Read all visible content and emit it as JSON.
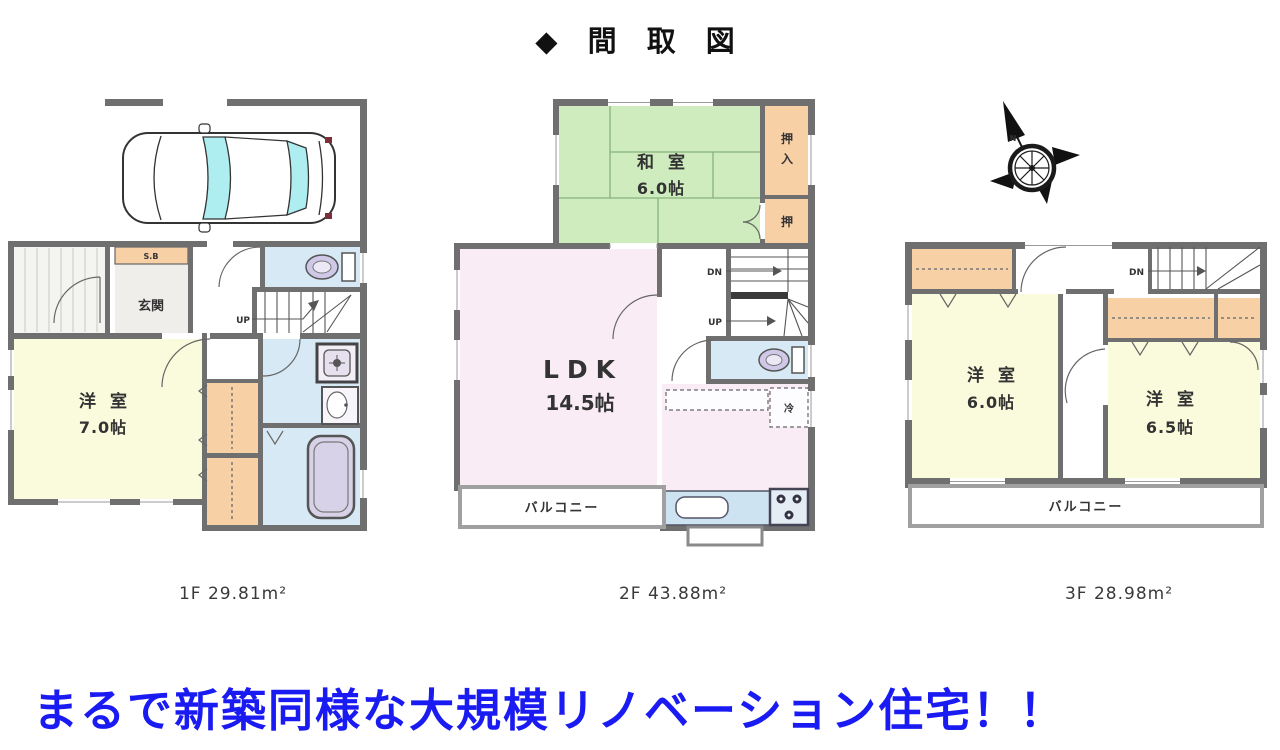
{
  "title": "◆ 間 取 図",
  "tagline": "まるで新築同様な大規模リノベーション住宅！！",
  "colors": {
    "wall_gray": "#6f6f6f",
    "room_yellow": "#fafadc",
    "tatami_green": "#cfecbf",
    "ldk_pink": "#f9ecf4",
    "closet_orange": "#f8d0a6",
    "wet_area_blue": "#d8e9f6",
    "car_glass_cyan": "#aeeef0",
    "tagline_blue": "#1a1af2"
  },
  "floor1": {
    "area_label": "1F 29.81m²",
    "genkan": "玄関",
    "shoebox": "S.B",
    "room_name": "洋 室",
    "room_size": "7.0帖",
    "up": "UP"
  },
  "floor2": {
    "area_label": "2F 43.88m²",
    "washitsu_name": "和 室",
    "washitsu_size": "6.0帖",
    "oshiire_top": "押",
    "oshiire_bottom": "入",
    "oshi": "押",
    "ldk_name": "LDK",
    "ldk_size": "14.5帖",
    "fridge": "冷",
    "balcony": "バルコニー",
    "dn": "DN",
    "up": "UP"
  },
  "floor3": {
    "area_label": "3F 28.98m²",
    "room1_name": "洋 室",
    "room1_size": "6.0帖",
    "room2_name": "洋 室",
    "room2_size": "6.5帖",
    "balcony": "バルコニー",
    "dn": "DN",
    "compass_n": "N"
  }
}
